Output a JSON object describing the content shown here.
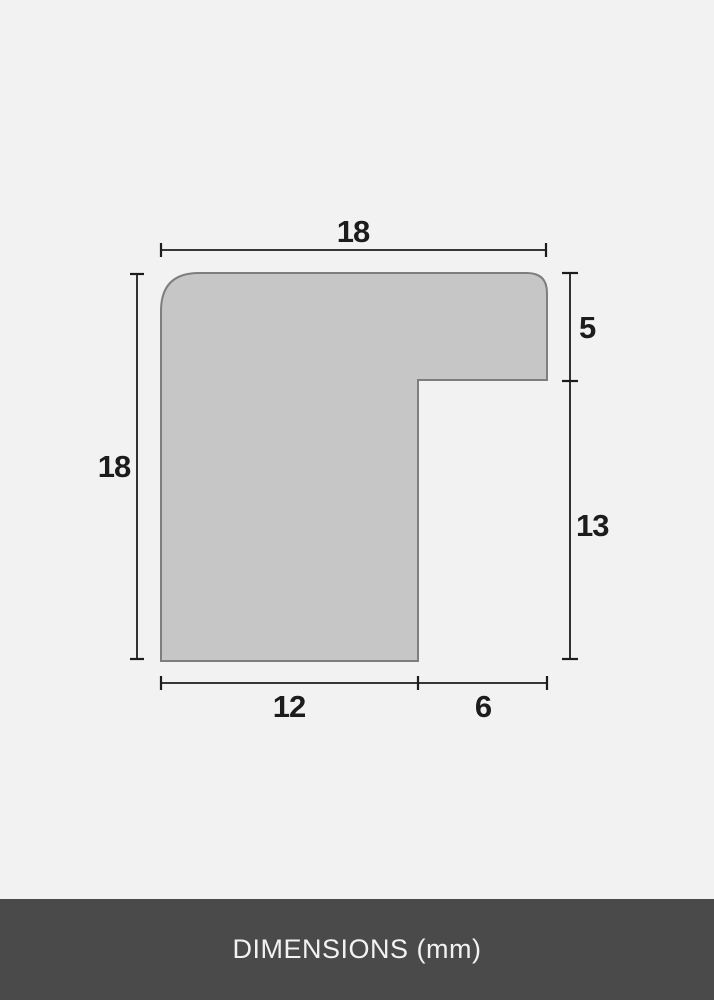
{
  "diagram": {
    "subject": "frame-moulding-profile-cross-section",
    "unit": "mm",
    "dimensions": {
      "top_width": "18",
      "left_height": "18",
      "right_upper": "5",
      "right_lower": "13",
      "bottom_inner": "12",
      "bottom_rabbet": "6"
    },
    "colors": {
      "background": "#f2f2f2",
      "shape_fill": "#c6c6c6",
      "shape_stroke": "#7e7e7e",
      "dimension_line": "#1c1c1c",
      "label_text": "#1c1c1c",
      "footer_bg": "#4a4a4b",
      "footer_text": "#f2f2f2"
    }
  },
  "footer": {
    "label": "DIMENSIONS (mm)"
  }
}
